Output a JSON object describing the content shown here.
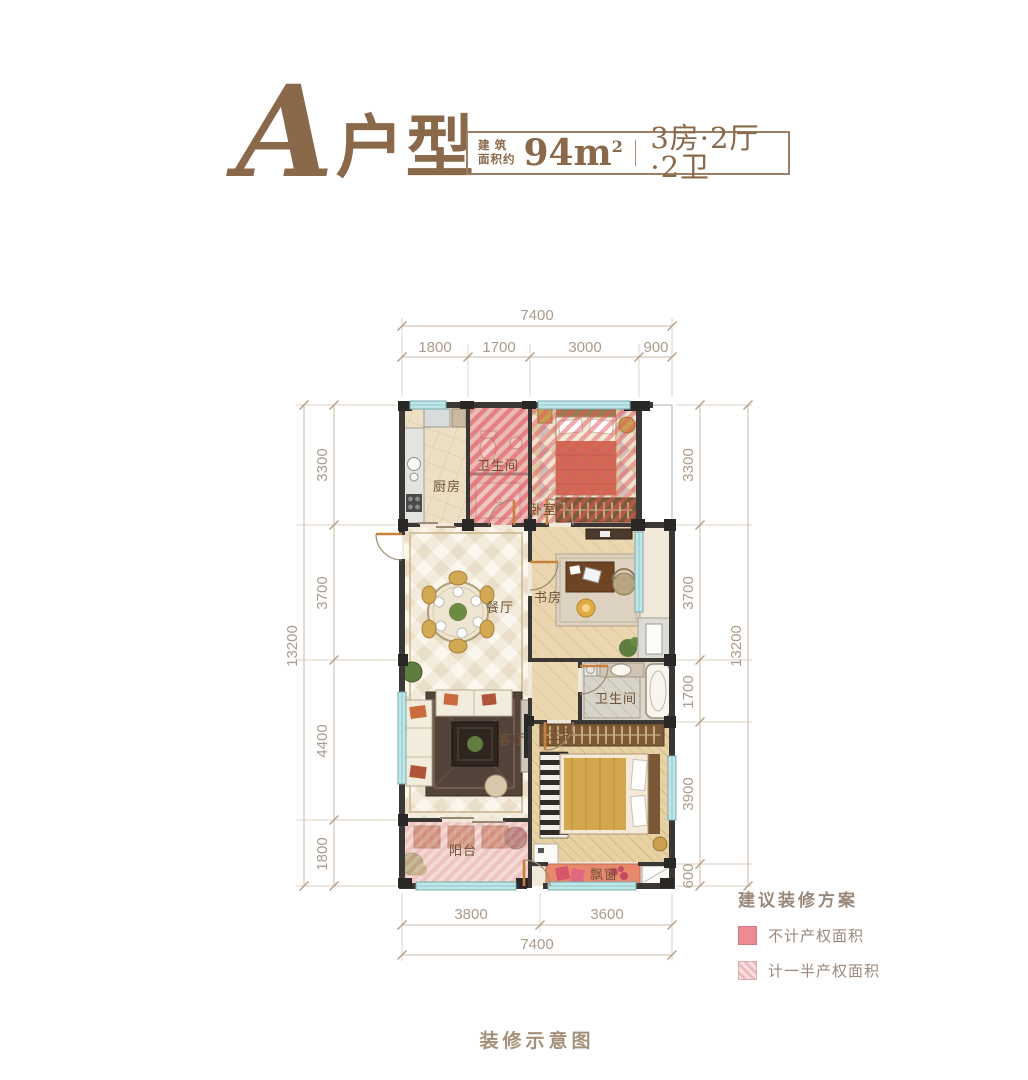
{
  "header": {
    "type_letter": "A",
    "type_suffix": "户型",
    "area_label_line1": "建 筑",
    "area_label_line2": "面积约",
    "area_value": "94m",
    "area_exponent": "2",
    "layout_spec": "3房·2厅·2卫"
  },
  "plan": {
    "rooms": {
      "kitchen": "厨房",
      "bath_top": "卫生间",
      "bedroom": "卧室",
      "dining": "餐厅",
      "study": "书房",
      "living": "客厅",
      "master": "主卧",
      "bath_master": "卫生间",
      "balcony": "阳台",
      "bay_window": "飘窗"
    },
    "dimensions": {
      "top": {
        "total": "7400",
        "segments": [
          "1800",
          "1700",
          "3000",
          "900"
        ]
      },
      "left": {
        "total": "13200",
        "segments": [
          "3300",
          "3700",
          "4400",
          "1800"
        ]
      },
      "right": {
        "total": "13200",
        "segments": [
          "3300",
          "3700",
          "1700",
          "3900",
          "600"
        ]
      },
      "bottom": {
        "total": "7400",
        "segments": [
          "3800",
          "3600"
        ]
      }
    }
  },
  "legend": {
    "title": "建议装修方案",
    "items": [
      {
        "label": "不计产权面积",
        "swatch": "solid",
        "color": "#ee8b92"
      },
      {
        "label": "计一半产权面积",
        "swatch": "hatch",
        "color": "#f3c7c8"
      }
    ]
  },
  "caption": "装修示意图",
  "colors": {
    "accent_brown": "#8a684a",
    "dim_line": "#c9b8a6",
    "dim_text": "#ab9b8a",
    "overlay_red": "#e2626c",
    "overlay_pink": "#eeb3b4",
    "wall_dark": "#2a2826"
  }
}
